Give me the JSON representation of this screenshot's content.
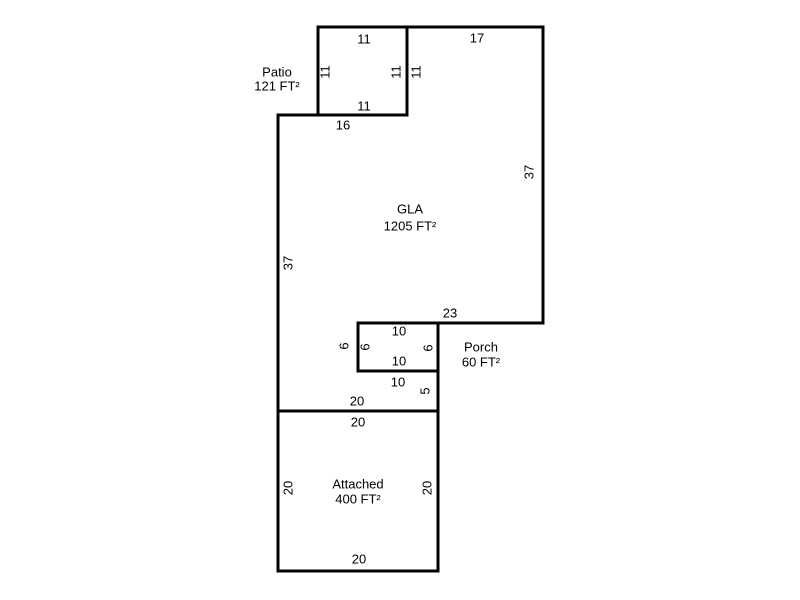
{
  "page": {
    "background": "#ffffff",
    "width": 800,
    "height": 600
  },
  "diagram": {
    "type": "floorplan-sketch",
    "stroke_color": "#000000",
    "text_color": "#000000",
    "stroke_width": 3,
    "font_size": 13,
    "shapes": [
      {
        "name": "patio-outline",
        "points": [
          [
            318,
            27
          ],
          [
            407,
            27
          ],
          [
            407,
            115
          ],
          [
            318,
            115
          ]
        ]
      },
      {
        "name": "gla-outline",
        "points": [
          [
            278,
            115
          ],
          [
            407,
            115
          ],
          [
            407,
            27
          ],
          [
            543,
            27
          ],
          [
            543,
            323
          ],
          [
            358,
            323
          ],
          [
            358,
            371
          ],
          [
            438,
            371
          ],
          [
            438,
            411
          ],
          [
            278,
            411
          ]
        ]
      },
      {
        "name": "porch-outline",
        "points": [
          [
            358,
            323
          ],
          [
            438,
            323
          ],
          [
            438,
            371
          ],
          [
            358,
            371
          ]
        ]
      },
      {
        "name": "attached-outline",
        "points": [
          [
            278,
            411
          ],
          [
            438,
            411
          ],
          [
            438,
            571
          ],
          [
            278,
            571
          ]
        ]
      }
    ],
    "areas": [
      {
        "name": "patio",
        "label": "Patio",
        "area": "121 FT²",
        "x": 277,
        "y1": 72,
        "y2": 86
      },
      {
        "name": "gla",
        "label": "GLA",
        "area": "1205 FT²",
        "x": 410,
        "y1": 209,
        "y2": 226
      },
      {
        "name": "porch",
        "label": "Porch",
        "area": "60 FT²",
        "x": 481,
        "y1": 347,
        "y2": 362
      },
      {
        "name": "attached",
        "label": "Attached",
        "area": "400 FT²",
        "x": 358,
        "y1": 484,
        "y2": 499
      }
    ],
    "dim_labels": [
      {
        "text": "11",
        "x": 364,
        "y": 39,
        "rot": false
      },
      {
        "text": "17",
        "x": 477,
        "y": 38,
        "rot": false
      },
      {
        "text": "11",
        "x": 325,
        "y": 72,
        "rot": true
      },
      {
        "text": "11",
        "x": 396,
        "y": 72,
        "rot": true
      },
      {
        "text": "11",
        "x": 416,
        "y": 72,
        "rot": true
      },
      {
        "text": "11",
        "x": 364,
        "y": 106,
        "rot": false
      },
      {
        "text": "16",
        "x": 343,
        "y": 125,
        "rot": false
      },
      {
        "text": "37",
        "x": 288,
        "y": 263,
        "rot": true
      },
      {
        "text": "37",
        "x": 529,
        "y": 172,
        "rot": true
      },
      {
        "text": "23",
        "x": 450,
        "y": 313,
        "rot": false
      },
      {
        "text": "10",
        "x": 399,
        "y": 331,
        "rot": false
      },
      {
        "text": "6",
        "x": 344,
        "y": 346,
        "rot": true
      },
      {
        "text": "6",
        "x": 365,
        "y": 347,
        "rot": true
      },
      {
        "text": "6",
        "x": 428,
        "y": 348,
        "rot": true
      },
      {
        "text": "10",
        "x": 399,
        "y": 361,
        "rot": false
      },
      {
        "text": "10",
        "x": 398,
        "y": 382,
        "rot": false
      },
      {
        "text": "5",
        "x": 425,
        "y": 391,
        "rot": true
      },
      {
        "text": "20",
        "x": 357,
        "y": 401,
        "rot": false
      },
      {
        "text": "20",
        "x": 358,
        "y": 422,
        "rot": false
      },
      {
        "text": "20",
        "x": 288,
        "y": 488,
        "rot": true
      },
      {
        "text": "20",
        "x": 427,
        "y": 488,
        "rot": true
      },
      {
        "text": "20",
        "x": 359,
        "y": 559,
        "rot": false
      }
    ]
  }
}
